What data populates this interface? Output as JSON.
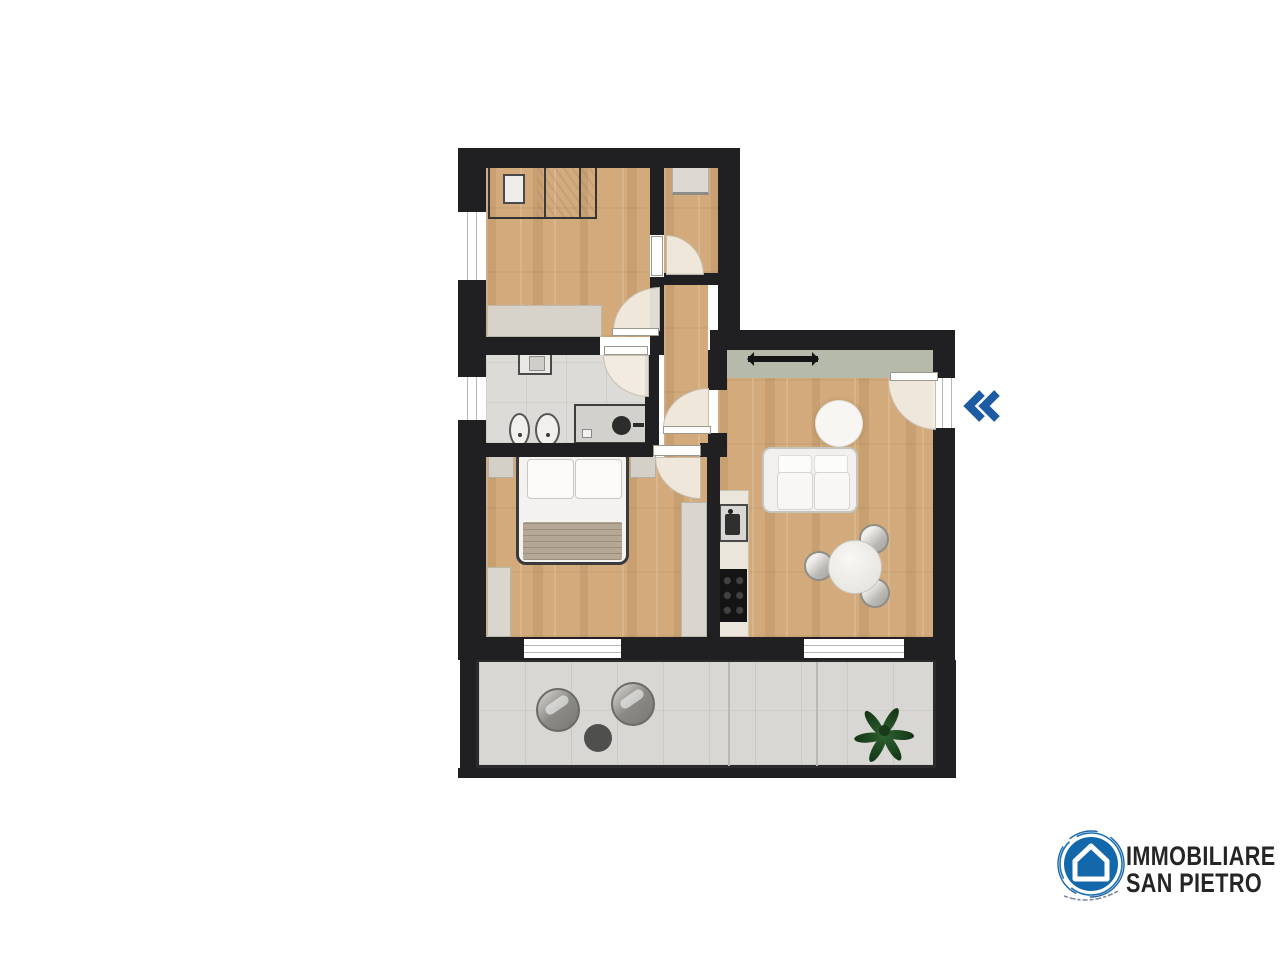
{
  "canvas": {
    "background": "#ffffff",
    "width": 1280,
    "height": 960
  },
  "floorplan": {
    "type": "apartment-floor-plan-top-view",
    "wall_color": "#202022",
    "floor_colors": {
      "wood": "#d2aa7b",
      "bathroom_tile": "#dcdbd7",
      "terrace_tile": "#d8d7d3",
      "closet_strip": "#b6baab"
    },
    "rooms": [
      {
        "id": "bedroom-1",
        "floor": "wood",
        "furniture": [
          "single-bed",
          "pillow",
          "sideboard"
        ],
        "windows": 1,
        "doors": 1
      },
      {
        "id": "study-nook",
        "floor": "wood",
        "furniture": [
          "desk"
        ],
        "doors": 1
      },
      {
        "id": "hallway",
        "floor": "wood",
        "furniture": []
      },
      {
        "id": "bathroom",
        "floor": "tile",
        "furniture": [
          "washbasin",
          "bidet",
          "toilet",
          "shower"
        ],
        "windows": 1,
        "doors": 1
      },
      {
        "id": "bedroom-2",
        "floor": "wood",
        "furniture": [
          "double-bed",
          "nightstand-left",
          "nightstand-right",
          "wardrobe",
          "dresser"
        ],
        "windows": 1,
        "doors": 1
      },
      {
        "id": "living-kitchen",
        "floor": "wood",
        "furniture": [
          "closet-rail",
          "sofa",
          "round-rug",
          "dining-table",
          "chairs-x3",
          "kitchen-counter",
          "sink",
          "cooktop"
        ],
        "windows": 1,
        "doors": 1
      },
      {
        "id": "terrace",
        "floor": "tile",
        "furniture": [
          "lounge-chair",
          "lounge-chair",
          "side-table",
          "plant"
        ]
      }
    ],
    "door_count": 6,
    "window_count": 4
  },
  "controls": {
    "prev_icon": "double-left-chevron",
    "prev_color": "#1d5ca3"
  },
  "logo": {
    "line1": "IMMOBILIARE",
    "line2": "SAN PIETRO",
    "badge_color": "#1368ac",
    "text_color": "#252525",
    "icon": "house"
  }
}
